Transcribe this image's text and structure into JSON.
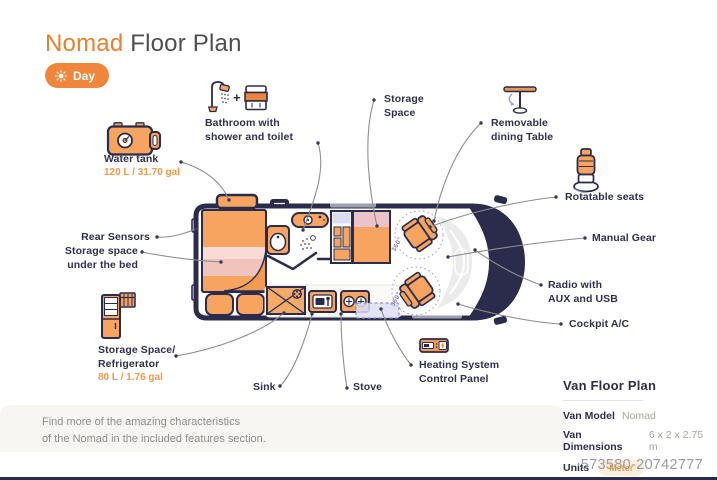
{
  "header": {
    "title_accent": "Nomad",
    "title_rest": " Floor Plan",
    "day_button": "Day",
    "plus_sign": "+"
  },
  "callouts": {
    "bathroom": "Bathroom with\nshower and toilet",
    "storage_space": "Storage\nSpace",
    "dining_table": "Removable\ndining Table",
    "water_tank": "Water tank",
    "water_tank_capacity": "120 L / 31.70 gal",
    "rear_sensors": "Rear Sensors",
    "storage_under_bed": "Storage space\nunder the bed",
    "refrigerator": "Storage Space/\nRefrigerator",
    "refrigerator_capacity": "80 L / 1.76 gal",
    "sink": "Sink",
    "stove": "Stove",
    "heating": "Heating System\nControl Panel",
    "rotatable_seats": "Rotatable seats",
    "manual_gear": "Manual Gear",
    "radio": "Radio with\nAUX and USB",
    "cockpit_ac": "Cockpit A/C"
  },
  "floorplan": {
    "rotation_label": "360°"
  },
  "note": "Find more of the amazing characteristics\nof the Nomad in the included features section.",
  "info_panel": {
    "title": "Van Floor Plan",
    "model_label": "Van Model",
    "model_value": "Nomad",
    "dimensions_label": "Van Dimensions",
    "dimensions_value": "6 x 2 x 2.75 m",
    "units_label": "Units",
    "units_value": "Meter"
  },
  "watermark": "573580-20742777",
  "colors": {
    "accent": "#ef8339",
    "navy": "#2b2b4c",
    "seat_orange": "#f6a45f",
    "pink": "#f2c9c0",
    "lavender": "#dcdcf0"
  }
}
